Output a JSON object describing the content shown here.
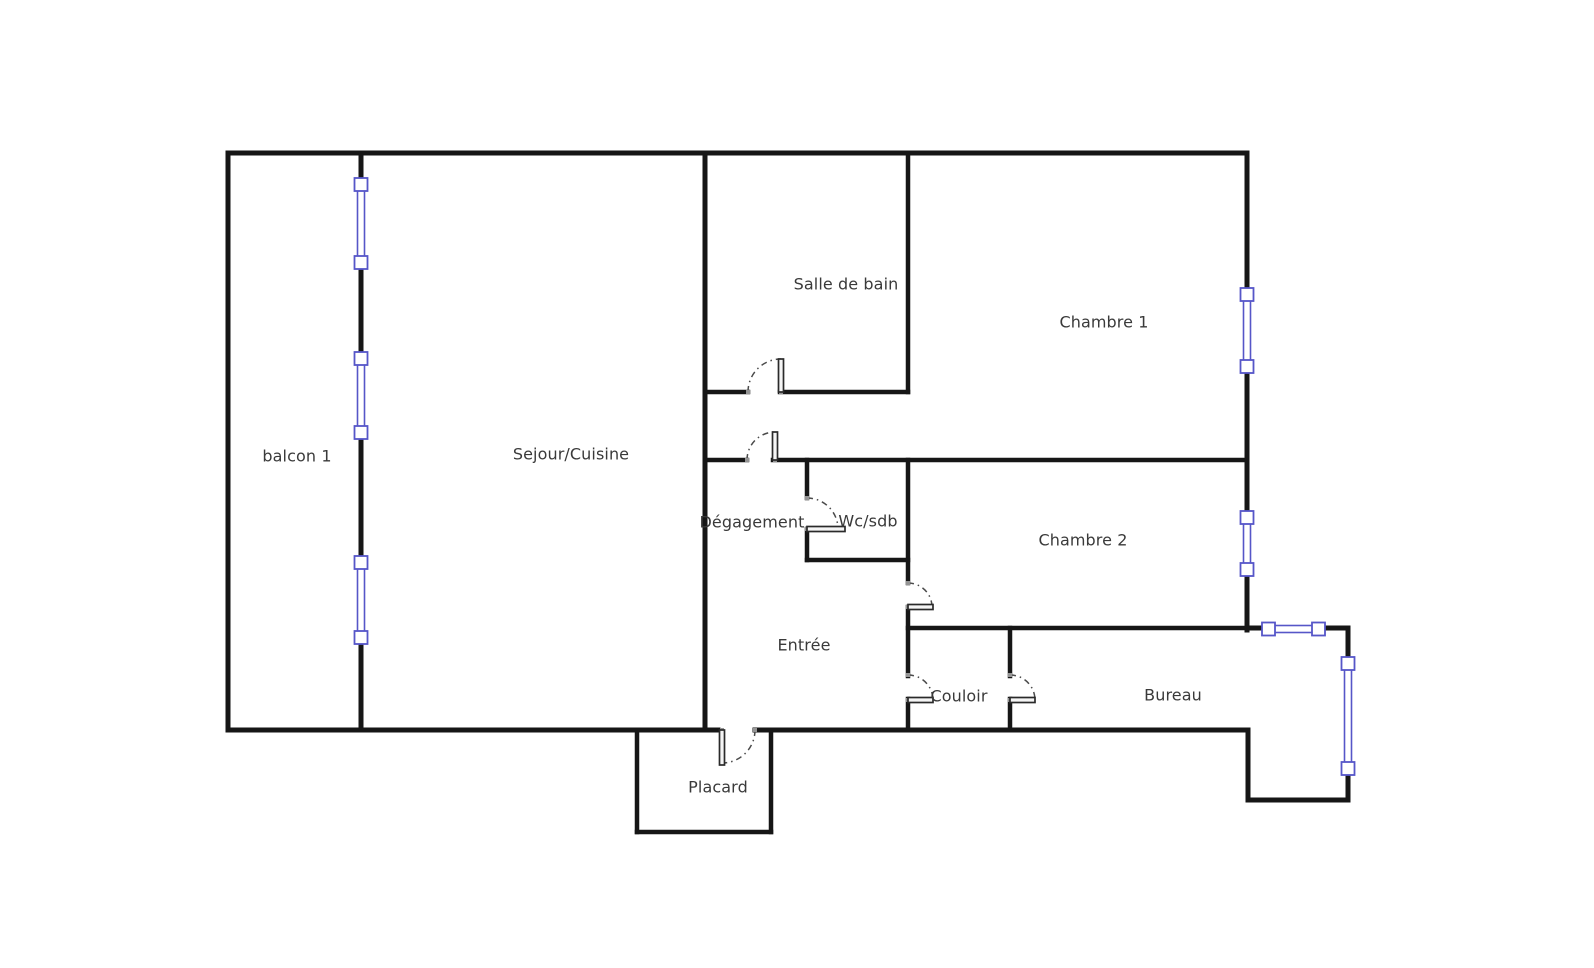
{
  "colors": {
    "background": "#ffffff",
    "wall": "#161616",
    "window": "#5656c8",
    "door_leaf": "#2a2a2a",
    "door_arc": "#4a4a4a",
    "text": "#3a3a3a"
  },
  "rooms": [
    {
      "id": "balcon-1",
      "label": "balcon 1"
    },
    {
      "id": "sejour-cuisine",
      "label": "Sejour/Cuisine"
    },
    {
      "id": "salle-de-bain",
      "label": "Salle de bain"
    },
    {
      "id": "chambre-1",
      "label": "Chambre 1"
    },
    {
      "id": "degagement",
      "label": "Dégagement"
    },
    {
      "id": "wc-sdb",
      "label": "Wc/sdb"
    },
    {
      "id": "chambre-2",
      "label": "Chambre 2"
    },
    {
      "id": "entree",
      "label": "Entrée"
    },
    {
      "id": "couloir",
      "label": "Couloir"
    },
    {
      "id": "bureau",
      "label": "Bureau"
    },
    {
      "id": "placard",
      "label": "Placard"
    }
  ]
}
